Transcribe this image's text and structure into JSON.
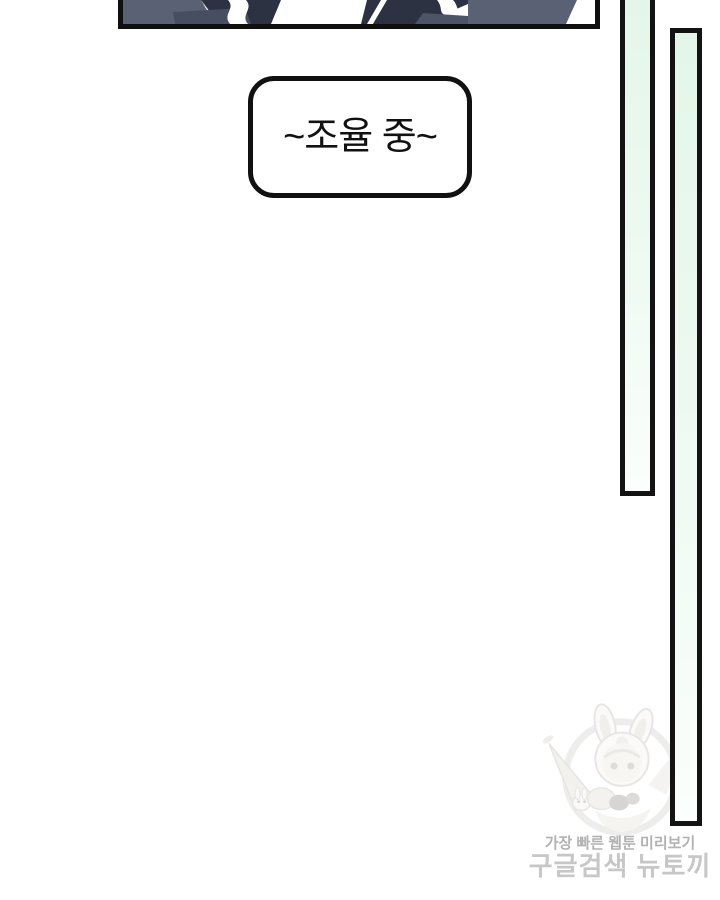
{
  "page": {
    "background": "#ffffff",
    "width": 720,
    "height": 900
  },
  "panel": {
    "colors": {
      "border": "#101010",
      "slate": "#5a6175",
      "slate_dark": "#474e61",
      "slate_mid": "#4d5467",
      "navy": "#2c3241",
      "white": "#ffffff"
    }
  },
  "speech_bubble": {
    "text": "~조율 중~",
    "text_color": "#111111",
    "fill": "#ffffff",
    "border_color": "#111111"
  },
  "side_bars": {
    "fill_top": "#e4f6e9",
    "fill_bottom": "#fbfefc",
    "border_color": "#131313"
  },
  "watermark": {
    "line1": "가장 빠른 웹툰 미리보기",
    "line2": "구글검색 뉴토끼",
    "line1_color": "#b2b2b2",
    "line2_color": "#c7c7c7",
    "mascot": "bunny-hood-girl-with-carrot"
  }
}
